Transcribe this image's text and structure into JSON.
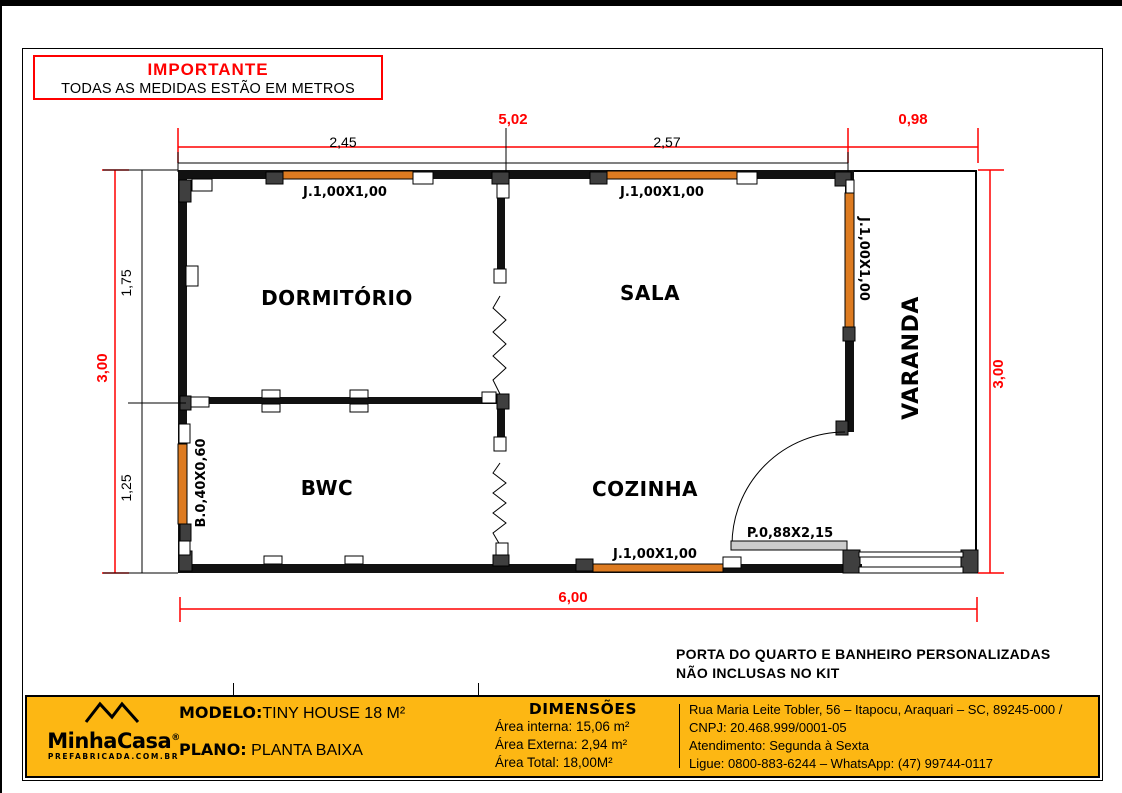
{
  "colors": {
    "accent_red": "#FF0000",
    "window_orange": "#DD7B21",
    "footer_yellow": "#FDB713",
    "door_gray": "#CCCCCC",
    "wall_black": "#111111"
  },
  "notice": {
    "title": "IMPORTANTE",
    "subtitle": "TODAS AS MEDIDAS ESTÃO EM METROS"
  },
  "plan": {
    "rooms": [
      "DORMITÓRIO",
      "SALA",
      "BWC",
      "COZINHA",
      "VARANDA"
    ],
    "dims": {
      "total_width": "5,02",
      "varanda_width": "0,98",
      "dorm_width": "2,45",
      "sala_width": "2,57",
      "height_left": "3,00",
      "dorm_depth": "1,75",
      "bwc_depth": "1,25",
      "height_right": "3,00",
      "bottom_width": "6,00"
    },
    "openings": {
      "dorm_window": "J.1,00X1,00",
      "sala_window_top": "J.1,00X1,00",
      "sala_window_side": "J.1,00X1,00",
      "bwc_window": "B.0,40X0,60",
      "kitchen_window": "J.1,00X1,00",
      "entry_door": "P.0,88X2,15"
    }
  },
  "note": {
    "line1": "PORTA DO QUARTO E BANHEIRO PERSONALIZADAS",
    "line2": "NÃO INCLUSAS NO KIT"
  },
  "footer": {
    "logo": {
      "brand": "MinhaCasa",
      "reg": "®",
      "tagline": "PREFABRICADA.COM.BR"
    },
    "modelo_label": "MODELO:",
    "modelo_value": "TINY HOUSE 18 M²",
    "plano_label": "PLANO:",
    "plano_value": " PLANTA BAIXA",
    "dimensoes": {
      "title": "DIMENSÕES",
      "area_interna": "Área interna: 15,06 m²",
      "area_externa": "Área Externa: 2,94 m²",
      "area_total": "Área Total: 18,00M²"
    },
    "contact": {
      "address": "Rua Maria Leite Tobler, 56 – Itapocu, Araquari – SC, 89245-000 / CNPJ: 20.468.999/0001-05",
      "hours": "Atendimento: Segunda à Sexta",
      "phone": "Ligue: 0800-883-6244 – WhatsApp: (47) 99744-0117"
    }
  }
}
